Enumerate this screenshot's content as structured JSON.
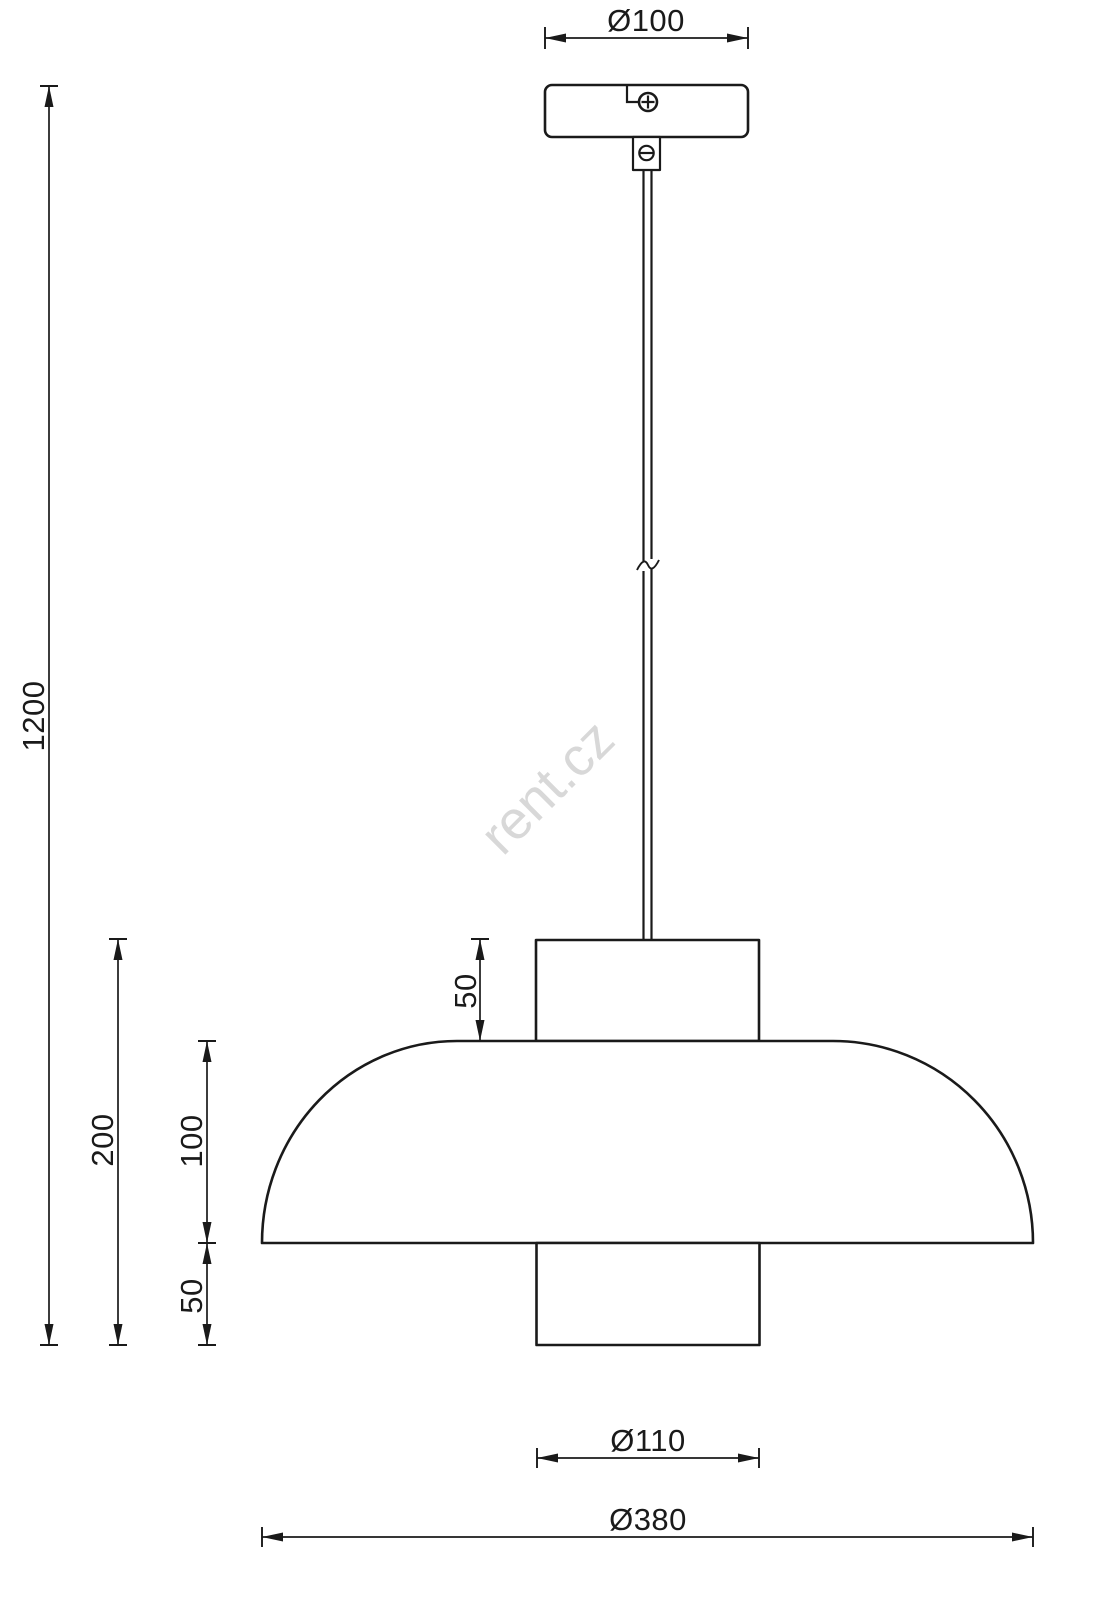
{
  "watermark": {
    "text": "rent.cz",
    "color": "#d8d8d8"
  },
  "colors": {
    "line": "#1a1a1a",
    "background": "#ffffff"
  },
  "dimensions": {
    "canopy_diameter": {
      "label": "Ø100",
      "value": 100
    },
    "total_drop": {
      "label": "1200",
      "value": 1200
    },
    "shade_total_height": {
      "label": "200",
      "value": 200
    },
    "dome_height": {
      "label": "100",
      "value": 100
    },
    "top_cylinder_height": {
      "label": "50",
      "value": 50
    },
    "bottom_cylinder_height": {
      "label": "50",
      "value": 50
    },
    "bottom_cylinder_diameter": {
      "label": "Ø110",
      "value": 110
    },
    "shade_diameter": {
      "label": "Ø380",
      "value": 380
    }
  }
}
